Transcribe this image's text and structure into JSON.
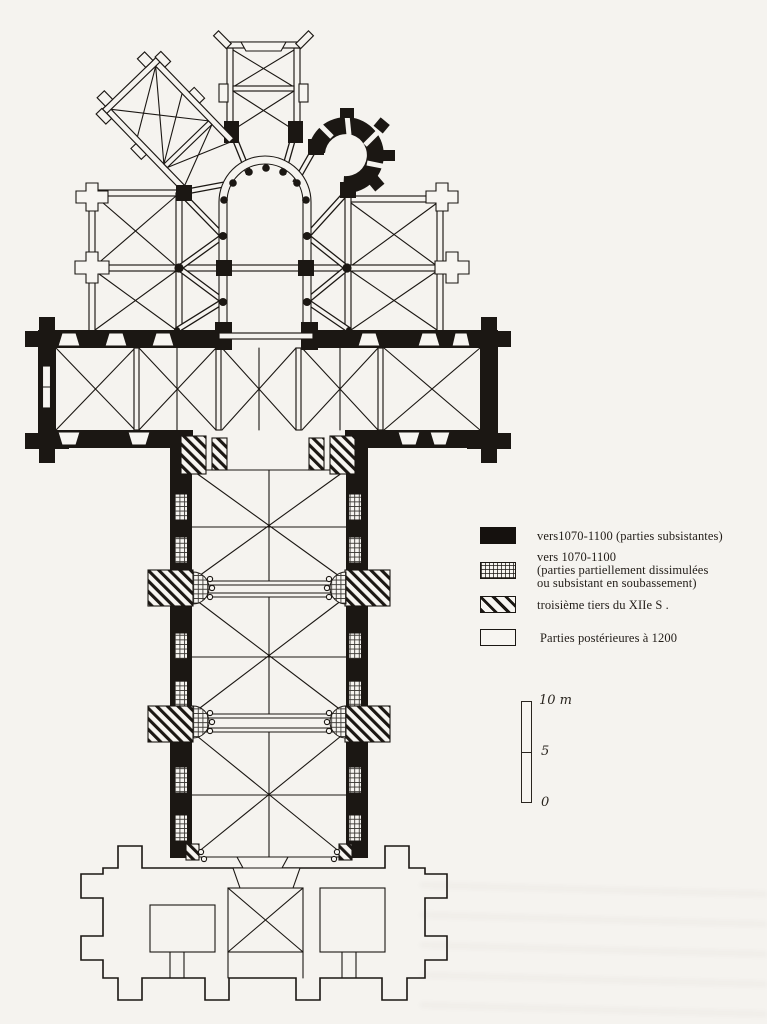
{
  "colors": {
    "paper": "#f5f3ef",
    "ink": "#1b1713"
  },
  "legend": {
    "items": [
      {
        "swatch": "solid-black",
        "lines": [
          "vers1070-1100  (parties subsistantes)"
        ]
      },
      {
        "swatch": "stippled",
        "lines": [
          "vers 1070-1100",
          "(parties partiellement dissimulées",
          "ou subsistant en soubassement)"
        ]
      },
      {
        "swatch": "diagonal-hatch",
        "lines": [
          "troisième tiers du XIIe S ."
        ]
      },
      {
        "swatch": "white-outline",
        "lines": [
          "Parties postérieures à 1200"
        ]
      }
    ]
  },
  "scale_bar": {
    "top_label": "10 m",
    "mid_label": "5",
    "bottom_label": "0"
  }
}
